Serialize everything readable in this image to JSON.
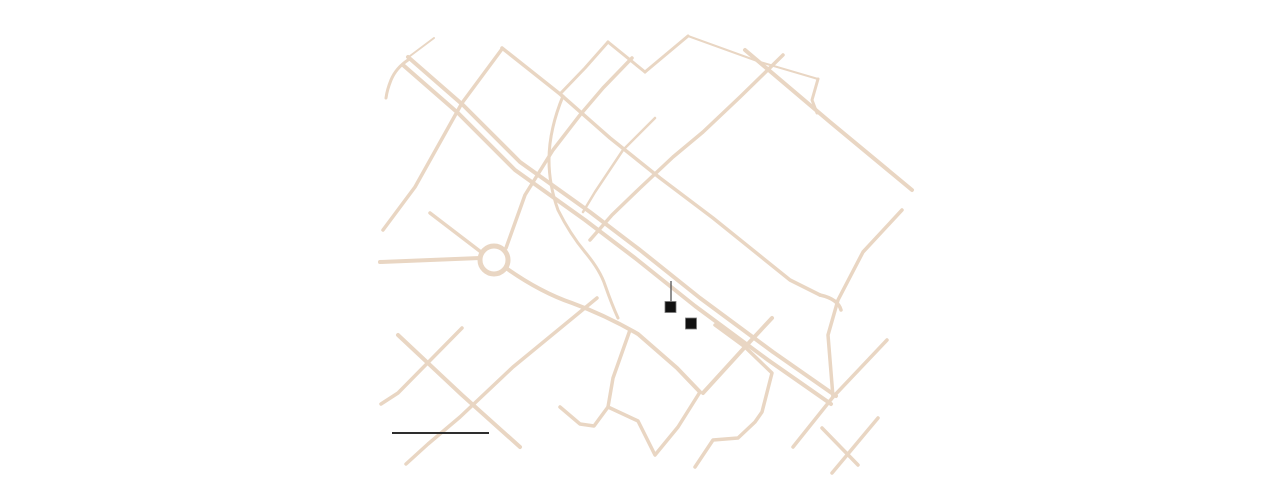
{
  "canvas": {
    "width": 1280,
    "height": 482,
    "background": "#ffffff"
  },
  "map": {
    "road_color": "#e9d6c3",
    "marker_color": "#111111",
    "marker_edge_color": "#7a7a7a",
    "leader_color": "#606060",
    "scale_bar_color": "#2e2e2e",
    "roundabout": {
      "cx": 494,
      "cy": 260,
      "r": 14,
      "w": 5
    },
    "roads": [
      {
        "id": "dual-carriageway-a",
        "d": "M408,57 L463,105 L520,162 L590,212 L640,250 L700,298 L773,352 L836,396",
        "w": 4
      },
      {
        "id": "dual-carriageway-b",
        "d": "M403,65 L458,113 L515,170 L585,220 L635,258 L695,306 L768,360 L831,404",
        "w": 4
      },
      {
        "id": "upper-parallel-avenue",
        "d": "M502,48 L560,94 L610,138 L660,178 L713,218 L790,280 L820,295",
        "w": 3.5
      },
      {
        "id": "upper-parallel-hook",
        "d": "M820,295 Q838,299 841,310",
        "w": 3.5
      },
      {
        "id": "northeast-avenue",
        "d": "M745,50 L830,122 L912,190",
        "w": 4
      },
      {
        "id": "southwest-street",
        "d": "M398,335 L462,395 L520,447",
        "w": 4
      },
      {
        "id": "bottom-right-street-a",
        "d": "M822,428 L858,465",
        "w": 3.5
      },
      {
        "id": "roundabout-nw-connector",
        "d": "M430,213 L481,252",
        "w": 3.5
      },
      {
        "id": "top-left-stub",
        "d": "M410,56 L434,38",
        "w": 2
      },
      {
        "id": "top-left-arc",
        "d": "M408,60 Q396,68 391,80 Q387,90 386,98",
        "w": 3
      },
      {
        "id": "west-cross-road",
        "d": "M502,49 L462,103 L415,187 L383,230",
        "w": 3.5
      },
      {
        "id": "roundabout-ne-road",
        "d": "M506,248 L525,195 L553,150 L580,115 L603,88 L632,58",
        "w": 3.5
      },
      {
        "id": "top-zigzag-a",
        "d": "M560,94 L585,68 L608,42",
        "w": 3
      },
      {
        "id": "top-zigzag-b",
        "d": "M608,42 L645,72",
        "w": 3
      },
      {
        "id": "top-zigzag-c",
        "d": "M645,72 L688,36",
        "w": 3
      },
      {
        "id": "top-thin-road",
        "d": "M688,36 L760,62 L818,79",
        "w": 2
      },
      {
        "id": "top-thin-hook",
        "d": "M818,79 L812,100 L817,113",
        "w": 3
      },
      {
        "id": "long-diagonal-cross",
        "d": "M783,55 L740,97 L703,132 L673,157 L640,188 L612,215 L590,240",
        "w": 3.5
      },
      {
        "id": "short-diagonal-cross",
        "d": "M655,118 L623,150 L595,192 L583,212",
        "w": 2.5
      },
      {
        "id": "east-cross-road",
        "d": "M902,210 L863,252 L838,300 L828,335 L833,397",
        "w": 3.5
      },
      {
        "id": "southeast-cross-road",
        "d": "M887,340 L833,397 L793,447",
        "w": 3.5
      },
      {
        "id": "south-central-cross",
        "d": "M772,318 L745,347 L703,393",
        "w": 4
      },
      {
        "id": "south-zigzag-east",
        "d": "M715,325 L745,347 L772,373 L762,412 L755,422 L738,438 L713,440 L695,467",
        "w": 3.5
      },
      {
        "id": "south-zigzag-center",
        "d": "M630,330 L613,378 L608,407 L638,421 L655,455 L678,427 L700,392",
        "w": 3.5
      },
      {
        "id": "south-zigzag-west",
        "d": "M560,407 L580,424 L594,426 L608,407",
        "w": 3.5
      },
      {
        "id": "southwest-diagonal",
        "d": "M597,298 L513,367 L460,417 L428,444 L406,464",
        "w": 3.5
      },
      {
        "id": "southwest-short-cross",
        "d": "M462,328 L398,393 L381,404",
        "w": 3.5
      },
      {
        "id": "bottom-right-street-b",
        "d": "M878,418 L832,473",
        "w": 3.5
      },
      {
        "id": "roundabout-west-road",
        "d": "M380,262 L480,258",
        "w": 4
      },
      {
        "id": "collector-curve-road",
        "d": "M506,268 Q540,292 572,303 Q605,315 638,334 L677,368 L700,392",
        "w": 4
      },
      {
        "id": "winding-vertical-road",
        "d": "M563,96 Q549,130 549,160 Q549,185 558,210 Q570,234 585,252 Q600,270 605,285 Q612,305 618,318",
        "w": 3
      }
    ],
    "markers": [
      {
        "id": "marker-1",
        "x": 670.5,
        "y": 307,
        "size": 11
      },
      {
        "id": "marker-2",
        "x": 691,
        "y": 323.5,
        "size": 11
      }
    ],
    "leader_line": {
      "x1": 671,
      "y1": 281,
      "x2": 671,
      "y2": 302,
      "w": 1.4
    },
    "scale_bar": {
      "x1": 392,
      "y1": 433,
      "x2": 489,
      "y2": 433,
      "w": 2
    }
  }
}
